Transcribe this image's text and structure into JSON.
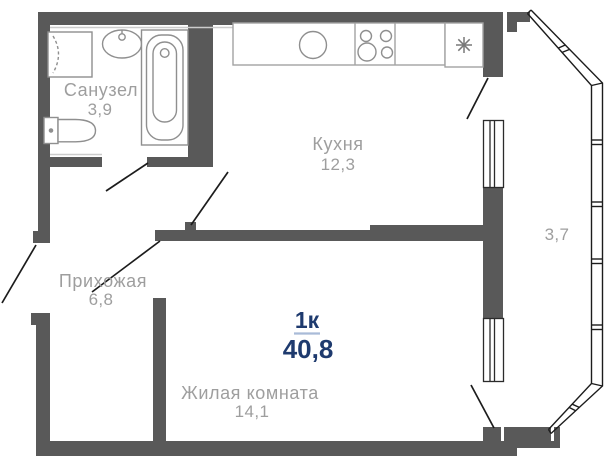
{
  "unit": {
    "type_label": "1к",
    "total_area": "40,8"
  },
  "rooms": [
    {
      "id": "bathroom",
      "name": "Санузел",
      "area": "3,9"
    },
    {
      "id": "kitchen",
      "name": "Кухня",
      "area": "12,3"
    },
    {
      "id": "hallway",
      "name": "Прихожая",
      "area": "6,8"
    },
    {
      "id": "living-room",
      "name": "Жилая комната",
      "area": "14,1"
    },
    {
      "id": "balcony",
      "area": "3,7"
    }
  ],
  "fixtures": [
    "washing-machine",
    "bathroom-sink",
    "bathtub",
    "toilet",
    "kitchen-counter",
    "kitchen-sink",
    "stove",
    "fridge-snowflake"
  ],
  "colors": {
    "walls": "#595959",
    "thin_lines": "#1c1c1c",
    "fixture_outline": "#8f8f8f",
    "room_labels": "#9e9e9e",
    "unit_accent": "#1e3a6e",
    "unit_underline": "#a9bbd8",
    "background": "#ffffff"
  }
}
